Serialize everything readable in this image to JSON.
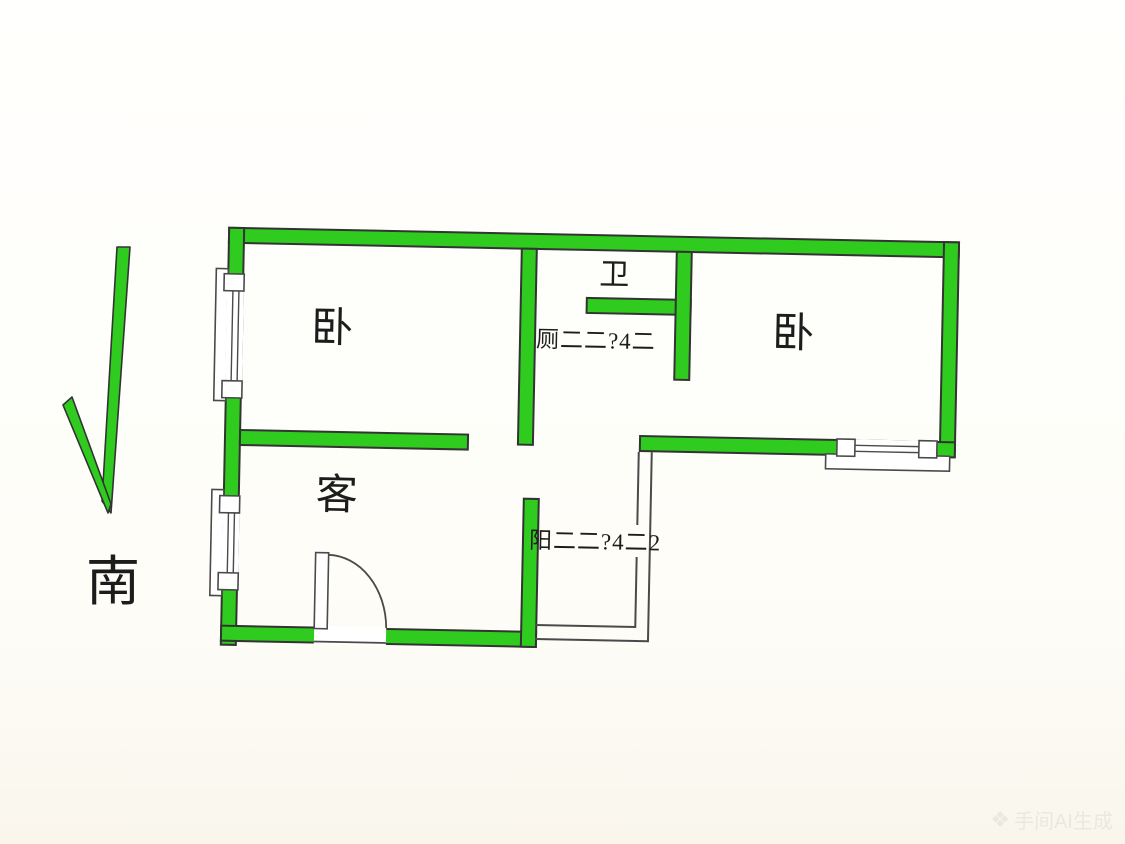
{
  "meta": {
    "background_color": "#fdfcf7",
    "wall_color": "#2fcc1f",
    "outline_color": "#333333",
    "thin_line_color": "#4a4a4a",
    "text_color": "#1c1c1c"
  },
  "compass": {
    "direction_label": "南"
  },
  "rooms": {
    "bedroom_left": {
      "label": "卧"
    },
    "bathroom": {
      "label": "卫"
    },
    "bedroom_right": {
      "label": "卧"
    },
    "living_room": {
      "label": "客"
    }
  },
  "annotations": {
    "bathroom_note": "厕二二?4二",
    "balcony_note": "阳二二?4二2"
  },
  "watermark": {
    "icon": "❖",
    "label": "手间AI生成"
  }
}
